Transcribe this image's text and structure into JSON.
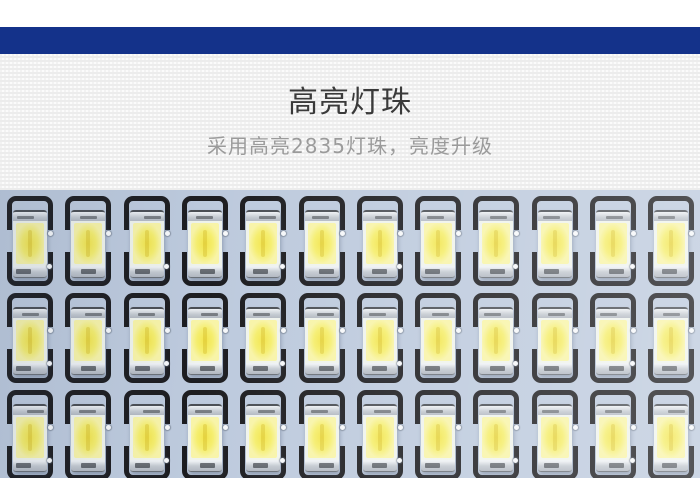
{
  "theme": {
    "divider_blue": "#14328a",
    "title_color": "#3a3a3a",
    "subtitle_color": "#9b9b9b"
  },
  "feature_section": {
    "title": "高亮灯珠",
    "subtitle": "采用高亮2835灯珠，亮度升级"
  },
  "photo": {
    "description": "close-up of LED panel PCB with grid of bright 2835 SMD LED chips",
    "pcb_color": "#bdcadd",
    "silkscreen_color": "#1d1d20",
    "led": {
      "ceramic_color": "#eff3ec",
      "phosphor_center": "#f2e44c",
      "phosphor_mid": "#f5ee6e",
      "phosphor_edge": "#f8f4a8",
      "pad_light": "#eef1f4",
      "pad_mid": "#c3c9d0",
      "pad_dark": "#b2b8c1",
      "pad_edge": "#4a4e54"
    },
    "grid": {
      "rows": 3,
      "cols": 12,
      "col_start": 7,
      "col_pitch": 58.3,
      "row_start": 6,
      "row_pitch": 97
    }
  }
}
